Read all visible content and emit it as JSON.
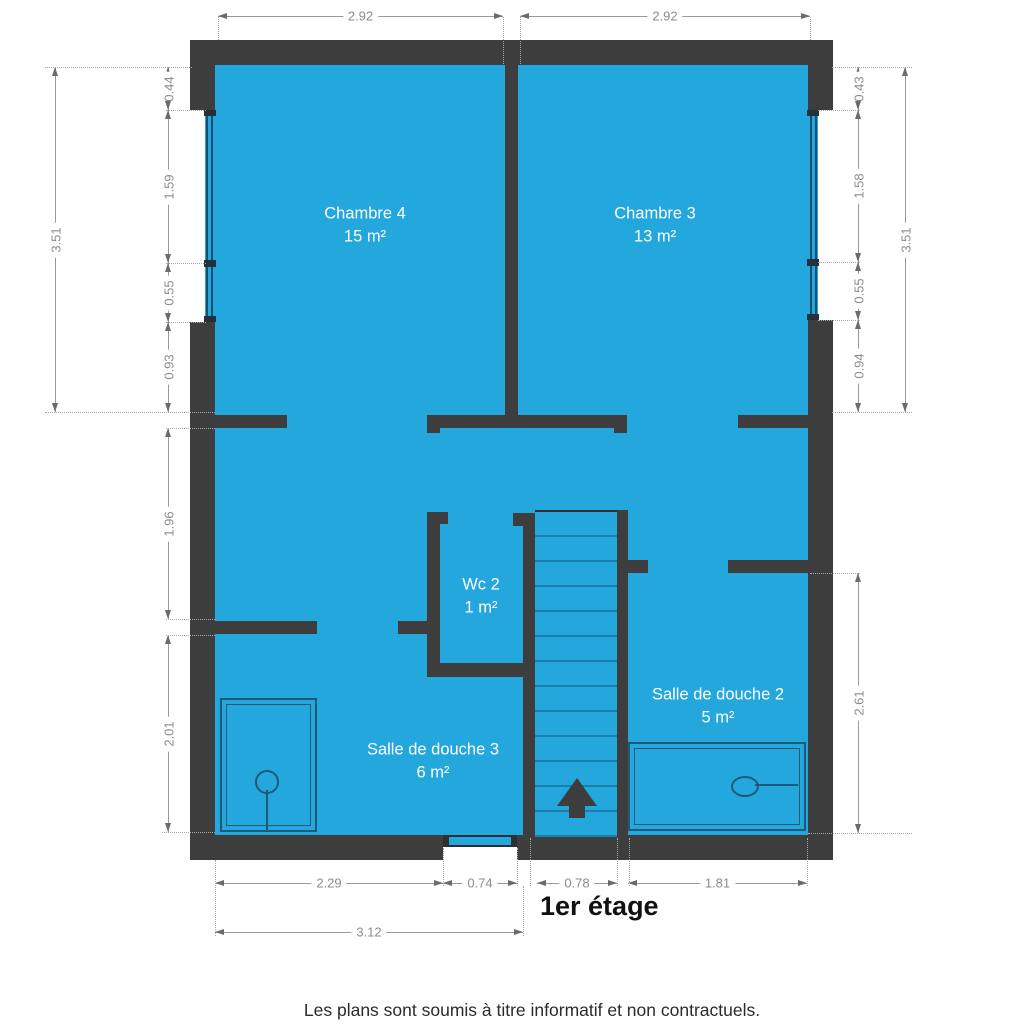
{
  "title": "1er étage",
  "footer": "Les plans sont soumis à titre informatif et non contractuels.",
  "rooms": {
    "chambre4": {
      "name": "Chambre 4",
      "area": "15 m²"
    },
    "chambre3": {
      "name": "Chambre 3",
      "area": "13 m²"
    },
    "wc2": {
      "name": "Wc 2",
      "area": "1 m²"
    },
    "salle_de_douche_3": {
      "name": "Salle de douche 3",
      "area": "6 m²"
    },
    "salle_de_douche_2": {
      "name": "Salle de douche 2",
      "area": "5 m²"
    }
  },
  "dimensions": {
    "top_left_width": "2.92",
    "top_right_width": "2.92",
    "left_total": "3.51",
    "left_seg1": "0.44",
    "left_seg2": "1.59",
    "left_seg3": "0.55",
    "left_seg4": "0.93",
    "left_seg5": "1.96",
    "left_seg6": "2.01",
    "right_total": "3.51",
    "right_seg1": "0.43",
    "right_seg2": "1.58",
    "right_seg3": "0.55",
    "right_seg4": "0.94",
    "right_seg5": "2.61",
    "bottom_seg1": "2.29",
    "bottom_seg2": "0.74",
    "bottom_seg3": "0.78",
    "bottom_seg4": "1.81",
    "bottom_total": "3.12"
  },
  "colors": {
    "room_fill": "#23a7dc",
    "wall": "#3d3d3d",
    "dim_line": "#999999",
    "dim_text": "#8c8c8c",
    "window_frame": "#16506e",
    "stair_line": "#1a7fae",
    "fixture": "#1d5a78",
    "title": "#111111"
  }
}
